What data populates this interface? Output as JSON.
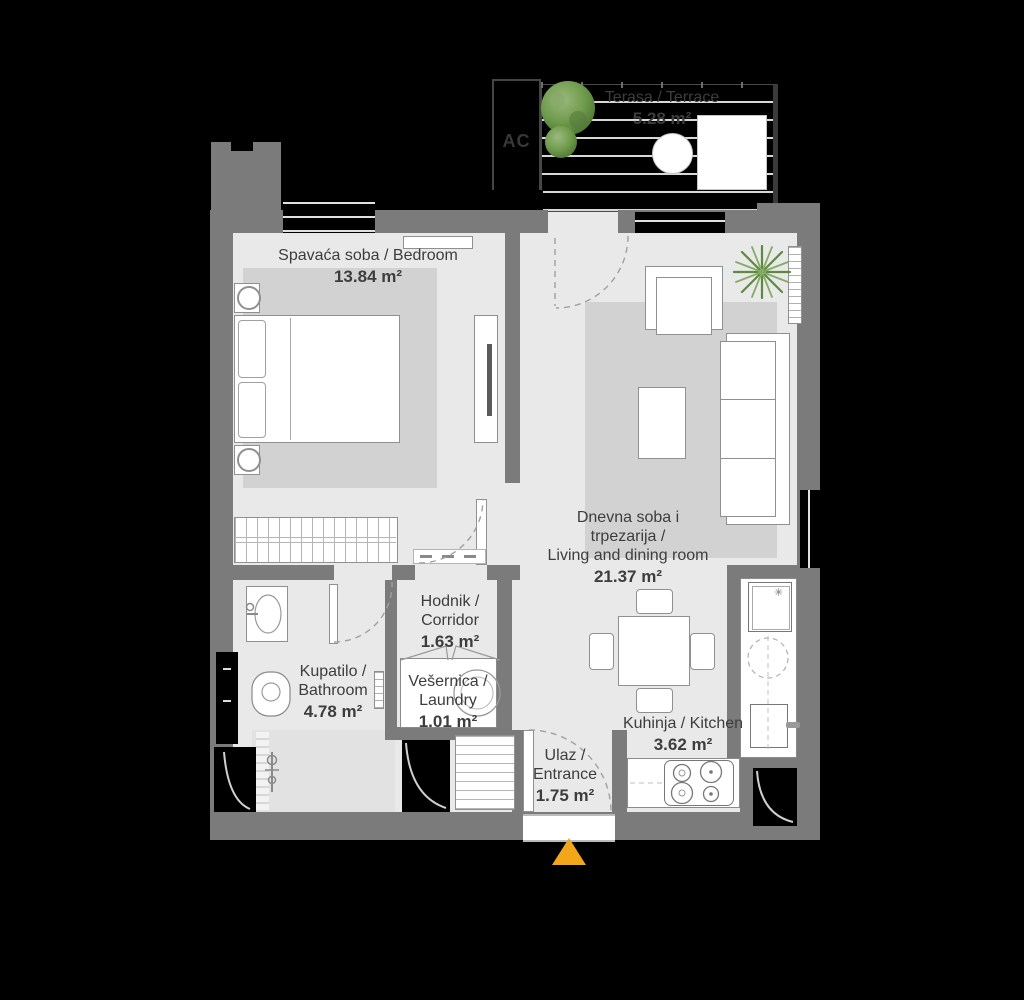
{
  "colors": {
    "wall": "#7b7b7b",
    "floor": "#e9e9e9",
    "rug": "#d2d2d2",
    "entrance_arrow": "#F2A71B",
    "label_text": "#3d3d3d",
    "plant_green": "#6f9b4c"
  },
  "rooms": {
    "terrace": {
      "name": "Terasa / Terrace",
      "area": "5.28 m²"
    },
    "bedroom": {
      "name": "Spavaća soba / Bedroom",
      "area": "13.84 m²"
    },
    "living": {
      "name_line1": "Dnevna soba i",
      "name_line2": "trpezarija /",
      "name_line3": "Living and dining room",
      "area": "21.37 m²"
    },
    "corridor": {
      "name_line1": "Hodnik /",
      "name_line2": "Corridor",
      "area": "1.63 m²"
    },
    "bathroom": {
      "name_line1": "Kupatilo /",
      "name_line2": "Bathroom",
      "area": "4.78 m²"
    },
    "laundry": {
      "name_line1": "Vešernica /",
      "name_line2": "Laundry",
      "area": "1.01 m²"
    },
    "kitchen": {
      "name": "Kuhinja / Kitchen",
      "area": "3.62 m²"
    },
    "entrance": {
      "name_line1": "Ulaz /",
      "name_line2": "Entrance",
      "area": "1.75 m²"
    }
  },
  "annotations": {
    "ac_label": "AC"
  }
}
